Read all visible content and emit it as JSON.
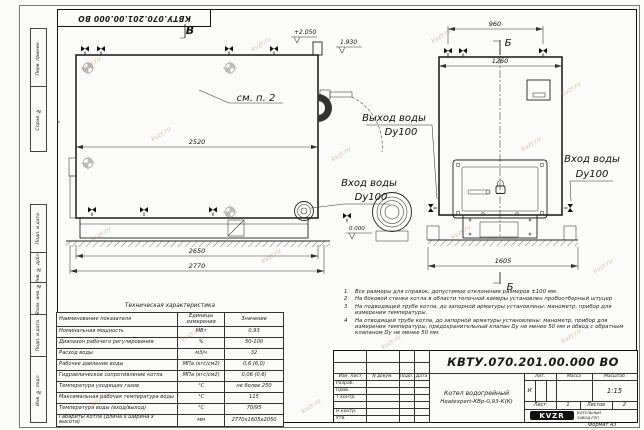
{
  "sheet": {
    "stamp_top": "КВТУ.070.201.00.000 ВО",
    "format_label": "Формат А3",
    "watermark": "kvzr.ru",
    "side_labels": [
      "Перв. примен.",
      "Справ. №",
      "Подп. и дата",
      "Инв. № дубл.",
      "Взам. инв. №",
      "Подп. и дата",
      "Инв. № подл."
    ]
  },
  "drawing": {
    "labels": {
      "view_b": "В",
      "view_a": "А",
      "section_b": "Б",
      "see_note": "см. п. 2",
      "elev_top": "+2.050",
      "elev_mid": "1.930",
      "elev_zero": "0.000",
      "water_out": "Выход воды",
      "water_in": "Вход воды",
      "dn": "Dy100"
    },
    "dimensions": {
      "d2520": "2520",
      "d2650": "2650",
      "d2770": "2770",
      "d960": "960",
      "d1260": "1260",
      "d1605": "1605"
    }
  },
  "tech_table": {
    "title": "Техническая характеристика",
    "headers": [
      "Наименование показателя",
      "Единицы измерения",
      "Значение"
    ],
    "rows": [
      [
        "Номинальная мощность",
        "МВт",
        "0,93"
      ],
      [
        "Диапазон рабочего регулирования",
        "%",
        "50-100"
      ],
      [
        "Расход воды",
        "м3/ч",
        "32"
      ],
      [
        "Рабочее давление воды",
        "МПа (кгс/см2)",
        "0,6 (6,0)"
      ],
      [
        "Гидравлическое сопротивление котла",
        "МПа (кгс/см2)",
        "0,06 (0,6)"
      ],
      [
        "Температура уходящих газов",
        "°С",
        "не более 250"
      ],
      [
        "Максимальная рабочая температура воды",
        "°С",
        "115"
      ],
      [
        "Температура воды (вход/выход)",
        "°С",
        "70/95"
      ],
      [
        "Габариты котла (длина х ширина х высота)",
        "мм",
        "2770х1605х2050"
      ]
    ]
  },
  "notes": {
    "items": [
      {
        "num": "1",
        "text": "Все размеры для справок, допустимое отклонение размеров ±100 мм."
      },
      {
        "num": "2",
        "text": "На боковой стенке котла в области топочной камеры установлен пробоотборный штуцер"
      },
      {
        "num": "3",
        "text": "На подводящей трубе котла, до запорной арматуры установлены: манометр, прибор для измерения температуры."
      },
      {
        "num": "4",
        "text": "На отводящей трубе котла, до запорной арматуры установлены: манометр, прибор для измерения температуры, предохранительный клапан Dy не менее 50 мм и обвод с обратным клапаном Dy не менее 50 мм."
      }
    ]
  },
  "title_block": {
    "doc_number": "КВТУ.070.201.00.000  ВО",
    "header_cells": [
      "Изм. Лист",
      "N докум.",
      "Подп.",
      "Дата"
    ],
    "row_labels": [
      "Разраб.",
      "Пров.",
      "Т.контр.",
      "Н.контр.",
      "Утв."
    ],
    "product_line1": "Котел водогрейный",
    "product_line2": "Heatexpert-КВр-0,93-К(К)",
    "lit_label": "Лит.",
    "mass_label": "Масса",
    "scale_label": "Масштаб",
    "lit_value": "И",
    "scale_value": "1:15",
    "sheet_label": "Лист",
    "sheet_value": "1",
    "sheets_label": "Листов",
    "sheets_value": "2",
    "logo_text": "KVZR",
    "company_line1": "КОТЕЛЬНЫЙ",
    "company_line2": "ЗАВОД РЭП"
  }
}
